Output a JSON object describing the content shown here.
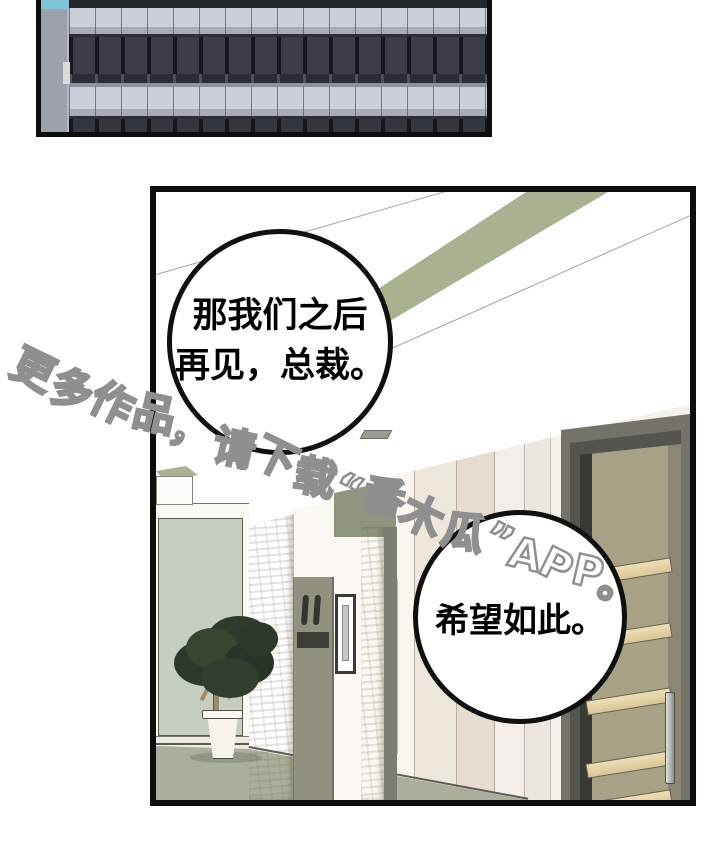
{
  "page": {
    "type": "comic-page",
    "background_color": "#ffffff",
    "panel_border_color": "#0e0e0e"
  },
  "top_panel": {
    "description": "exterior office-building facade with horizontal window bands",
    "colors": {
      "sky": "#7fc4d9",
      "column": "#9da1ac",
      "light_band": "#cbcfd9",
      "mid_band": "#a8acb7",
      "dark_windows": "#3a3d44",
      "window_frames": "#15171c"
    }
  },
  "main_panel": {
    "description": "office hallway interior with elevator alcove, potted plant, stone pillars, intercom panel and wooden door",
    "colors": {
      "ceiling_band_green": "#a8b190",
      "alcove_wall_green": "#c6cebf",
      "stone": "#ddd6c1",
      "olive_panel": "#90917f",
      "floor": "#a9af9b",
      "door_frame": "#73736a",
      "door_body": "#a7a186",
      "door_slats": "#e3d2a8",
      "corridor_wall": "#f3eeea"
    }
  },
  "bubbles": [
    {
      "line1": "那我们之后",
      "line2": "再见，总裁。"
    },
    {
      "line1": "希望如此。"
    }
  ],
  "watermark": {
    "text": "更多作品，请下载“番木瓜”APP。",
    "fill_color": "#ffffff",
    "outline_color": "#8f8f8f"
  }
}
